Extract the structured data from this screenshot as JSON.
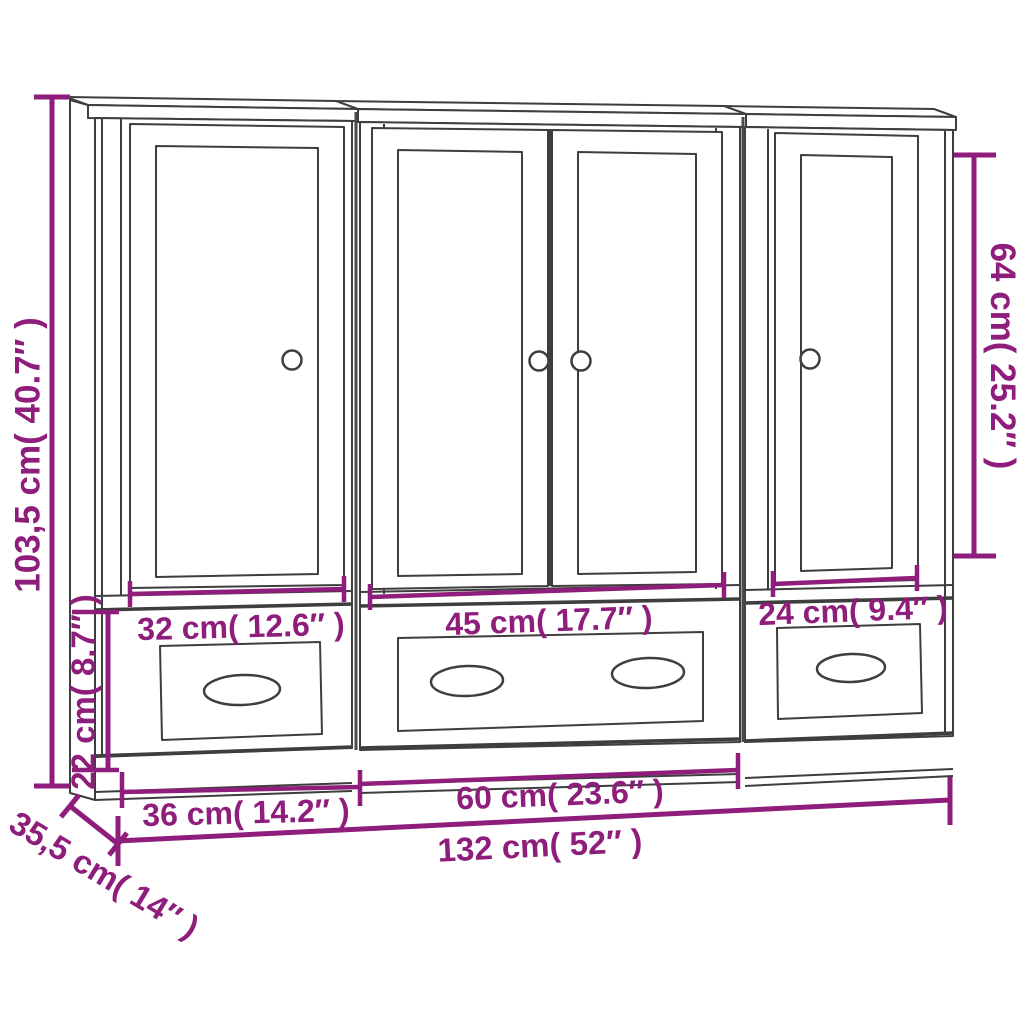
{
  "diagram": {
    "type": "furniture-dimension-drawing",
    "subject": "3-piece highboard cabinet set (2 single-door units, 1 double-door unit, each with drawer)",
    "colors": {
      "dimension": "#8e1d7b",
      "line": "#3e3e3e",
      "background": "#ffffff"
    },
    "labels": {
      "total_height": "103,5 cm( 40.7″ )",
      "drawer_section_height": "22 cm( 8.7″ )",
      "right_door_height": "64 cm( 25.2″ )",
      "left_door_width": "32 cm( 12.6″ )",
      "middle_doors_width": "45 cm( 17.7″ )",
      "right_door_width": "24 cm( 9.4″ )",
      "left_unit_width": "36 cm( 14.2″ )",
      "middle_unit_width": "60 cm( 23.6″ )",
      "total_width": "132 cm( 52″ )",
      "depth": "35,5 cm( 14″ )"
    }
  }
}
